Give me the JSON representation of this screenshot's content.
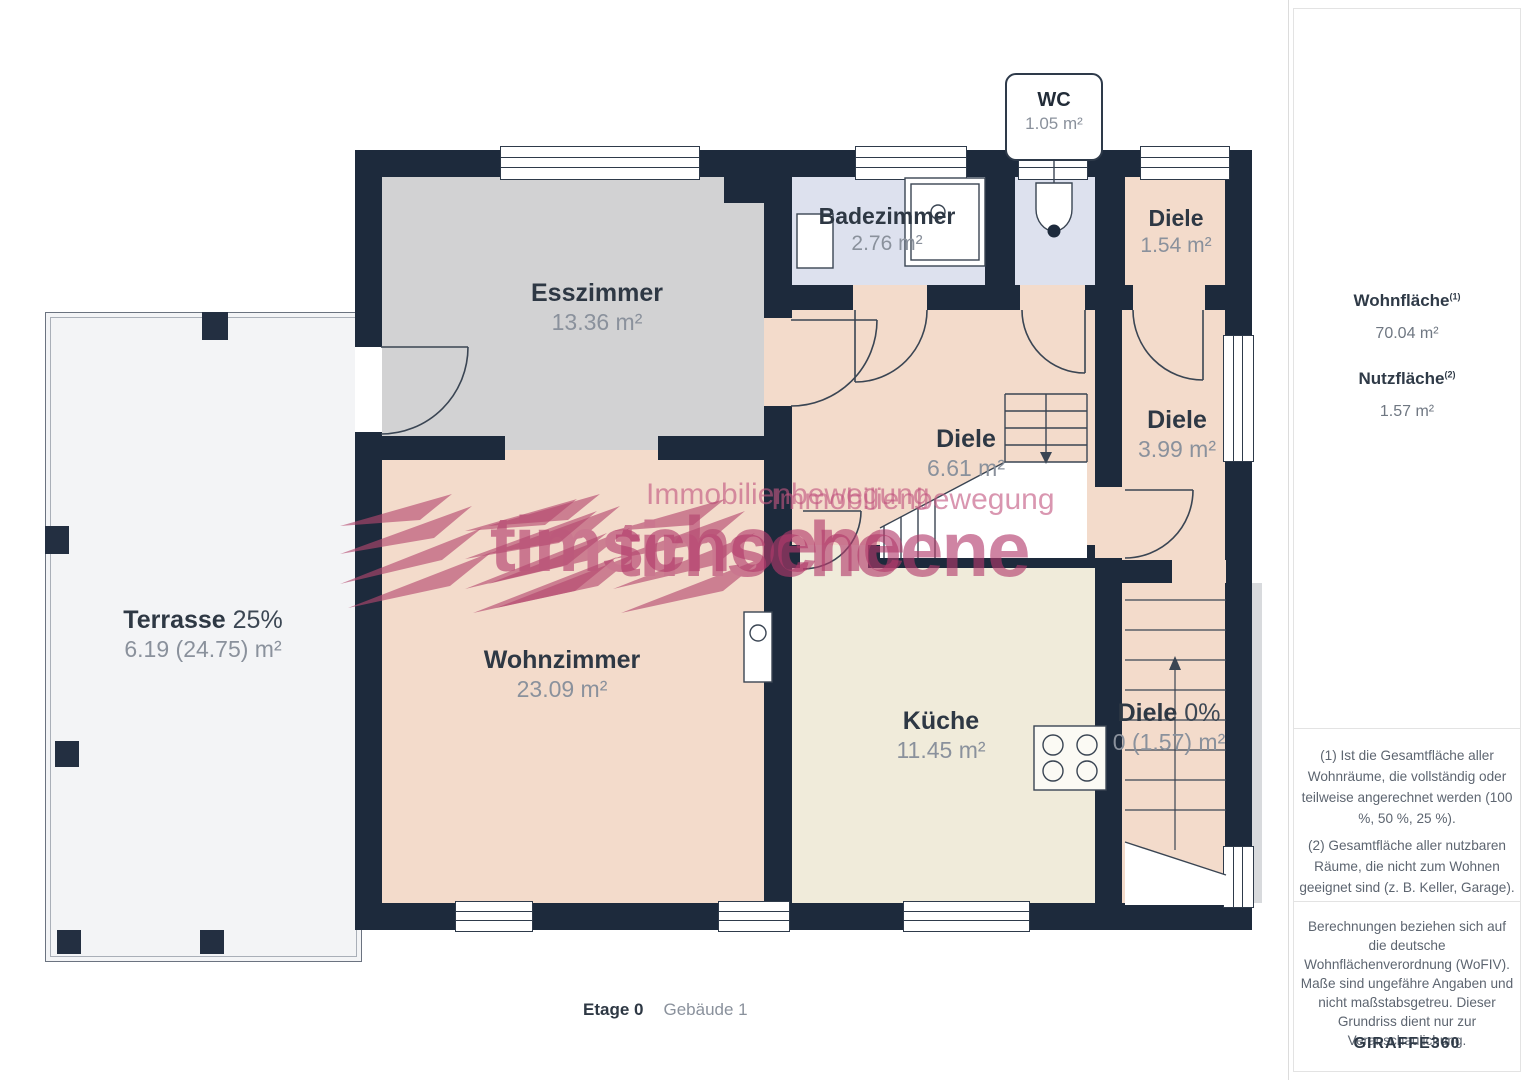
{
  "plan": {
    "callout_wc": {
      "name": "WC",
      "area": "1.05 m²"
    },
    "rooms": {
      "esszimmer": {
        "name": "Esszimmer",
        "area": "13.36 m²"
      },
      "badezimmer": {
        "name": "Badezimmer",
        "area": "2.76 m²"
      },
      "diele_1": {
        "name": "Diele",
        "area": "1.54 m²"
      },
      "diele_2": {
        "name": "Diele",
        "area": "6.61 m²"
      },
      "diele_3": {
        "name": "Diele",
        "area": "3.99 m²"
      },
      "terrasse": {
        "name": "Terrasse",
        "percent": "25%",
        "area": "6.19 (24.75) m²"
      },
      "wohnzimmer": {
        "name": "Wohnzimmer",
        "area": "23.09 m²"
      },
      "kueche": {
        "name": "Küche",
        "area": "11.45 m²"
      },
      "diele_4": {
        "name": "Diele",
        "percent": "0%",
        "area": "0 (1.57) m²"
      }
    },
    "caption": {
      "floor": "Etage 0",
      "building": "Gebäude 1"
    }
  },
  "watermark": {
    "line1": "Immobilienbewegung",
    "line2": "timschoene"
  },
  "sidebar": {
    "wohnflaeche": {
      "label": "Wohnfläche",
      "sup": "(1)",
      "value": "70.04 m²"
    },
    "nutzflaeche": {
      "label": "Nutzfläche",
      "sup": "(2)",
      "value": "1.57 m²"
    },
    "footnote1": "(1) Ist die Gesamtfläche aller Wohnräume, die vollständig oder teilweise angerechnet werden (100 %, 50 %, 25 %).",
    "footnote2": "(2) Gesamtfläche aller nutzbaren Räume, die nicht zum Wohnen geeignet sind (z. B. Keller, Garage).",
    "disclaimer": "Berechnungen beziehen sich auf die deutsche Wohnflächenverordnung (WoFIV). Maße sind ungefähre Angaben und nicht maßstabsgetreu. Dieser Grundriss dient nur zur Veranschaulichung.",
    "brand": "GIRAFFE",
    "brand_suffix": "360"
  },
  "colors": {
    "wall": "#1d2a3c",
    "hall_floor": "#f3dbcb",
    "kitchen_floor": "#f0ebda",
    "bath_floor": "#dde1ee",
    "dining_floor": "#d2d2d3",
    "terrace_floor": "#f3f4f6",
    "watermark": "#b23a6b"
  }
}
